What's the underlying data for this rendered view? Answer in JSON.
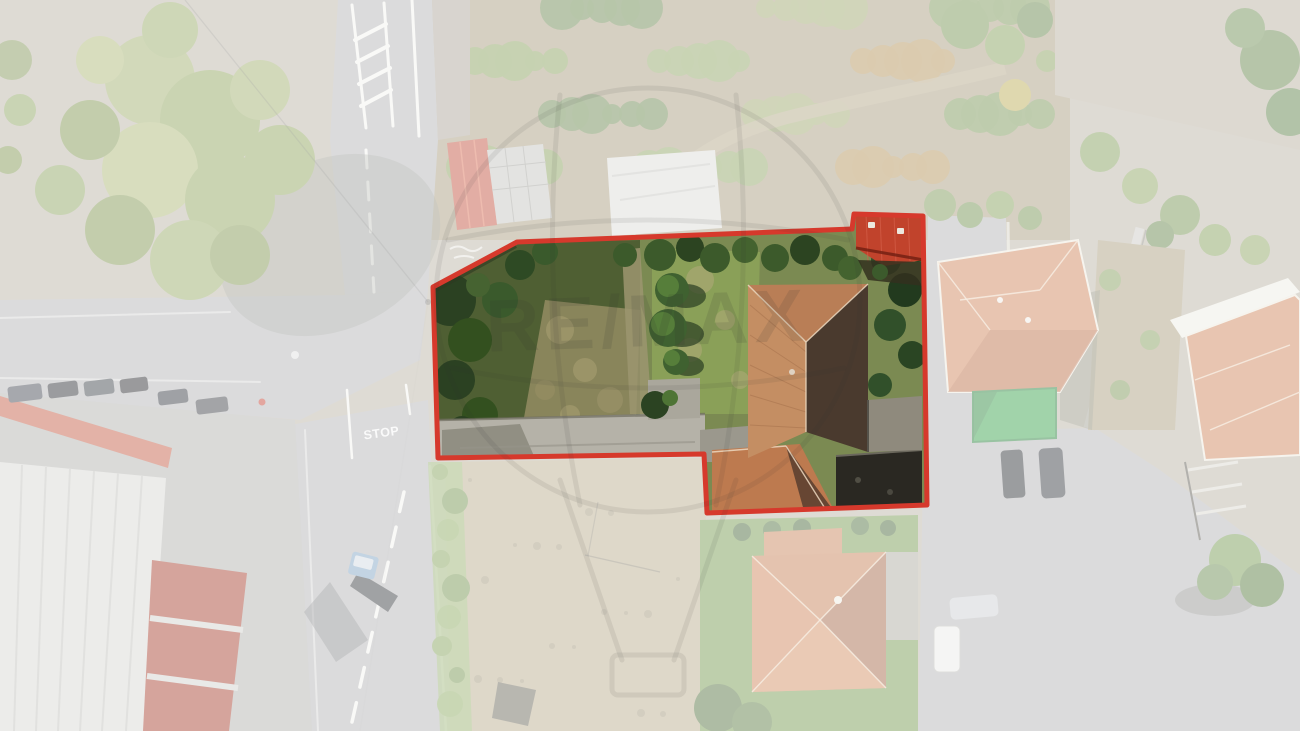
{
  "boundary": {
    "color": "#d6392c",
    "stroke_width": 5,
    "points": "433,287 517,242 852,229 854,214 923,216 927,505 707,513 704,454 438,458"
  },
  "road_marking": {
    "stop_label": "STOP"
  },
  "watermark": {
    "brand": "RE/MAX"
  },
  "colors": {
    "boundary_red": "#d6392c",
    "asphalt": "#b0b0b2",
    "forest_base": "#a59878",
    "grass_inside": "#7b8a52",
    "grass_lawn": "#6f9448",
    "court_green": "#2f9e44",
    "warehouse_red": "#a33524",
    "roof_terracotta": "#cd7f52",
    "roof_shadow": "#4a3a2e",
    "wash_white": "#ffffff"
  }
}
